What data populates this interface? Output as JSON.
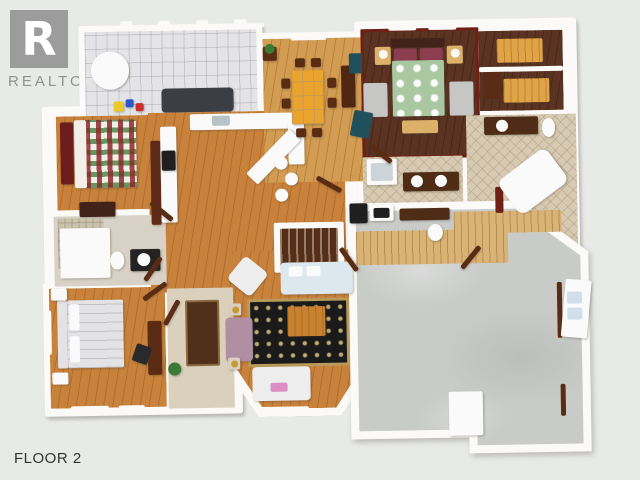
{
  "window": {
    "background": "#e8eae8"
  },
  "logo": {
    "r_glyph": "R",
    "name": "REALTOR",
    "registered": "®"
  },
  "floor_label": "FLOOR 2",
  "rooms": [
    "deck",
    "children-bedroom",
    "kitchen",
    "dining-room",
    "master-bedroom",
    "walk-in-closets",
    "master-bathroom",
    "main-bathroom",
    "hall-bathroom",
    "bedroom",
    "foyer",
    "living-room",
    "staircase",
    "unfinished-room"
  ],
  "palette": {
    "background": "#e8eae8",
    "logo_gray": "#9c9c9c",
    "logo_text": "#8e9390",
    "label_text": "#2f3533",
    "wall": "#fbfaf8",
    "deck_tile": "#e4e4e7",
    "honey": "#c8823c",
    "dining_wood": "#d29c52",
    "walnut": "#5a3322",
    "maroon": "#6e2016",
    "bath_tile": "#d7cab2",
    "hall_tile": "#d8d2c6",
    "stone": "#cbc2ae",
    "carpet": "#dbd0bc",
    "concrete": "#c9cbc9",
    "runner": "#50301a",
    "rug_black": "#1a1a1a",
    "rug_gold": "#b89a5a",
    "sofa_white": "#ededed",
    "sofa_blue": "#dde7ee",
    "pink": "#dc8fc4",
    "mauve": "#b18fa2",
    "teal": "#20505c",
    "duvet_green": "#a9c7a1",
    "pillow_maroon": "#8c3d50",
    "quilt_base": "#f2efe8",
    "headboard_red": "#6e1d1d",
    "bed_white": "#e3e3e6",
    "tan": "#dcb16a",
    "shelf_orange": "#e0a446",
    "wood_dark": "#5b2c14",
    "wood_mid": "#c8812e",
    "black": "#1f1f1f",
    "white": "#fafafa",
    "gray_rug": "#c6c6c4",
    "plant": "#3a7a34",
    "lamp_gold": "#c79a36",
    "steel": "#b9c2c6",
    "stair_wood": "#542e18",
    "wood_strip": "#d9b275",
    "glass": "#cfe0ec",
    "dark_sofa": "#3b3e42",
    "dresser": "#43221a",
    "cab_red": "#5f2a1a",
    "vanity_dark": "#4e2c16",
    "vanity_black": "#232323",
    "desk_gray": "#2a2a2c",
    "table_orange": "#eaa32c",
    "hutch": "#4f2713",
    "side_table": "#d8cfc0",
    "orange_toy": "#e8c82a",
    "blue_toy": "#2a58c8",
    "red_toy": "#c83030",
    "shower_glass": "#cdd4d8"
  }
}
